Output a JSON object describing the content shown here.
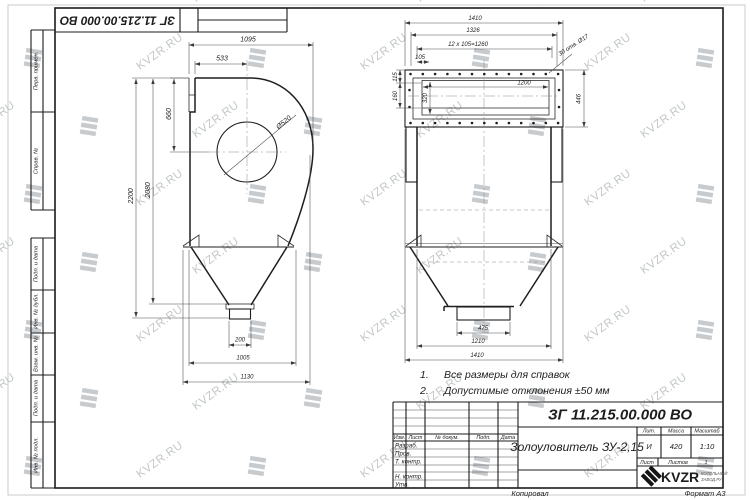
{
  "watermark": {
    "text": "KVZR.RU"
  },
  "corner_stamp": {
    "designation": "ЗГ 11.215.00.000 ВО"
  },
  "margin_labels": {
    "b1": "Перв. примен.",
    "b2": "Справ. №",
    "b3": "Подп. и дата",
    "b4": "Инв. № дубл.",
    "b5": "Взам. инв. №",
    "b6": "Подп. и дата",
    "b7": "Инв. № подл."
  },
  "left_view": {
    "d1095": "1095",
    "d533": "533",
    "d660": "660",
    "dia": "Ø520",
    "d2200": "2200",
    "d2080": "2080",
    "d200": "200",
    "d1005": "1005",
    "d1130": "1130"
  },
  "right_view": {
    "d1410_top": "1410",
    "d1326": "1326",
    "d_pitch": "12 x 105=1260",
    "d105": "105",
    "d1200": "1200",
    "holes": "30 отв. Ø17",
    "d115": "115",
    "d160": "160",
    "d320": "320",
    "d446": "446",
    "d475": "475",
    "d1210": "1210",
    "d1410_bottom": "1410"
  },
  "notes": {
    "n1_num": "1.",
    "n1_text": "Все размеры для справок",
    "n2_num": "2.",
    "n2_text": "Допустимые отклонения  ±50 мм"
  },
  "title_block": {
    "designation": "ЗГ 11.215.00.000 ВО",
    "name": "Золоуловитель ЗУ-2,15",
    "cols": {
      "izm": "Изм.",
      "list": "Лист",
      "dokum": "№ докум.",
      "podp": "Подп.",
      "data": "Дата"
    },
    "rows": {
      "razrab": "Разраб.",
      "prov": "Пров.",
      "tkontr": "Т. контр.",
      "nkontr": "Н. контр.",
      "utv": "Утв."
    },
    "lit_label": "Лит.",
    "lit": "И",
    "massa_label": "Масса",
    "massa": "420",
    "scale_label": "Масштаб",
    "scale": "1:10",
    "list_label": "Лист",
    "listov_label": "Листов",
    "listov": "1",
    "logo": "KVZR",
    "logo_sub1": "КОТЕЛЬНЫЙ",
    "logo_sub2": "ЗАВОД.РУ",
    "kopiroval": "Копировал",
    "format": "Формат А3"
  }
}
